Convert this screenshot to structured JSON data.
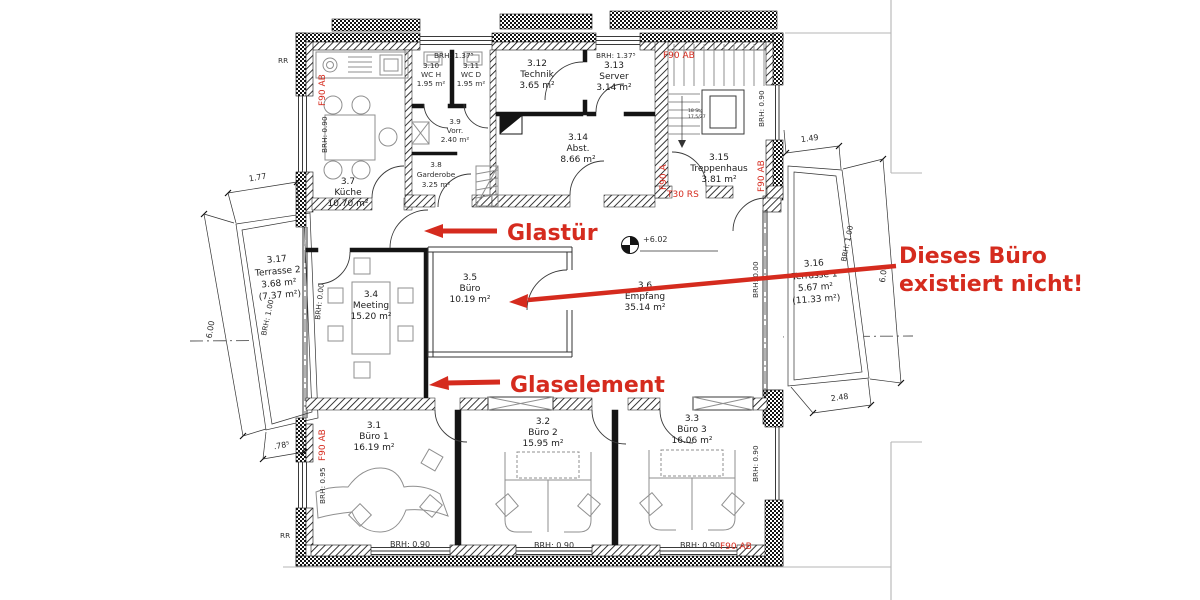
{
  "rooms": {
    "kueche": {
      "num": "3.7",
      "name": "Küche",
      "area": "10.70 m²"
    },
    "garderobe": {
      "num": "3.8",
      "name": "Garderobe",
      "area": "3.25 m²"
    },
    "vorr": {
      "num": "3.9",
      "name": "Vorr.",
      "area": "2.40 m²"
    },
    "wch": {
      "num": "3.10",
      "name": "WC H",
      "area": "1.95 m²"
    },
    "wcd": {
      "num": "3.11",
      "name": "WC D",
      "area": "1.95 m²"
    },
    "technik": {
      "num": "3.12",
      "name": "Technik",
      "area": "3.65 m²"
    },
    "server": {
      "num": "3.13",
      "name": "Server",
      "area": "3.14 m²"
    },
    "abst": {
      "num": "3.14",
      "name": "Abst.",
      "area": "8.66 m²"
    },
    "treppenhaus": {
      "num": "3.15",
      "name": "Treppenhaus",
      "area": "3.81 m²"
    },
    "meeting": {
      "num": "3.4",
      "name": "Meeting",
      "area": "15.20 m²"
    },
    "buero": {
      "num": "3.5",
      "name": "Büro",
      "area": "10.19 m²"
    },
    "empfang": {
      "num": "3.6",
      "name": "Empfang",
      "area": "35.14 m²"
    },
    "terrasse2": {
      "num": "3.17",
      "name": "Terrasse 2",
      "area": "3.68 m²",
      "area2": "(7.37 m²)"
    },
    "terrasse1": {
      "num": "3.16",
      "name": "Terrasse 1",
      "area": "5.67 m²",
      "area2": "(11.33 m²)"
    },
    "buero1": {
      "num": "3.1",
      "name": "Büro 1",
      "area": "16.19 m²"
    },
    "buero2": {
      "num": "3.2",
      "name": "Büro 2",
      "area": "15.95 m²"
    },
    "buero3": {
      "num": "3.3",
      "name": "Büro 3",
      "area": "16.06 m²"
    }
  },
  "annotations": {
    "glastuer": "Glastür",
    "glaselement": "Glaselement",
    "not_exists_1": "Dieses Büro",
    "not_exists_2": "existiert nicht!"
  },
  "fire_ratings": {
    "f90ab": "F90 AB",
    "f90a": "F90 A",
    "t30rs": "T30 RS"
  },
  "sill_heights": {
    "h137": "BRH: 1.37⁵",
    "h100": "BRH: 1.00",
    "h095": "BRH: 0.95",
    "h090": "BRH: 0.90",
    "h000": "BRH: 0.00"
  },
  "dimensions": {
    "d600": "6.00",
    "d177": "1.77",
    "d078": ".78⁵",
    "d149": "1.49",
    "d248": "2.48"
  },
  "elevation_mark": "+6.02",
  "stair_note": {
    "l1": "18 Stg",
    "l2": "17,5/27"
  },
  "misc": {
    "rr": "RR"
  },
  "colors": {
    "annotation_red": "#d52b1e",
    "wall_black": "#141414",
    "furniture_gray": "#8f8f8f"
  }
}
